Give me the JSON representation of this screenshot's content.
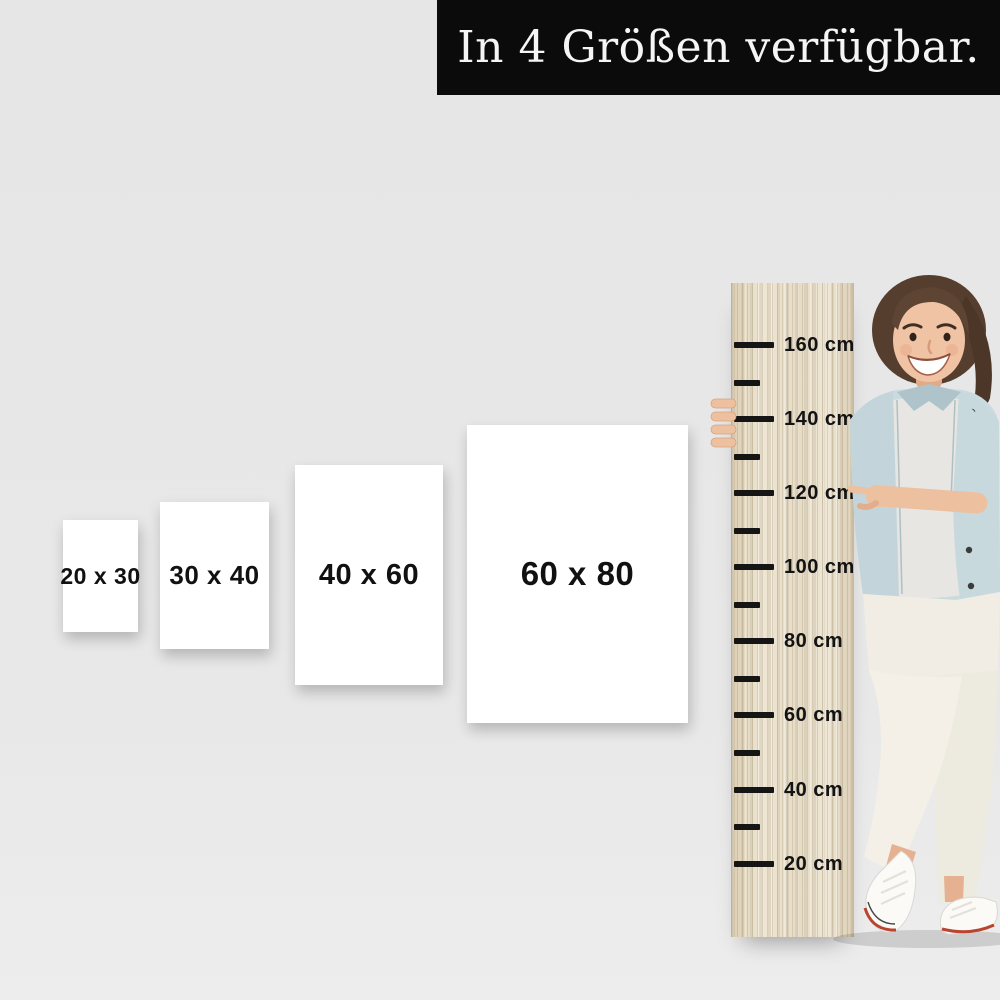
{
  "banner": {
    "text": "In 4 Größen verfügbar."
  },
  "sizes": {
    "labels": [
      "20 x 30",
      "30 x 40",
      "40 x 60",
      "60 x 80"
    ]
  },
  "ruler": {
    "labels": [
      "160 cm",
      "140 cm",
      "120 cm",
      "100 cm",
      "80 cm",
      "60 cm",
      "40 cm",
      "20 cm"
    ]
  },
  "colors": {
    "background": "#e7e7e7",
    "banner_bg": "#0b0b0b",
    "banner_text": "#f5f5f5",
    "card_bg": "#ffffff",
    "card_text": "#111111",
    "wood": "#e9e0cd",
    "tick": "#151515",
    "hair": "#553e2e",
    "skin": "#efc3a4",
    "denim_jacket": "#cbdade",
    "shirt": "#e7e6e3",
    "pants": "#f1ede4",
    "shoe": "#fbfaf7",
    "shoe_accent": "#b9452f"
  }
}
